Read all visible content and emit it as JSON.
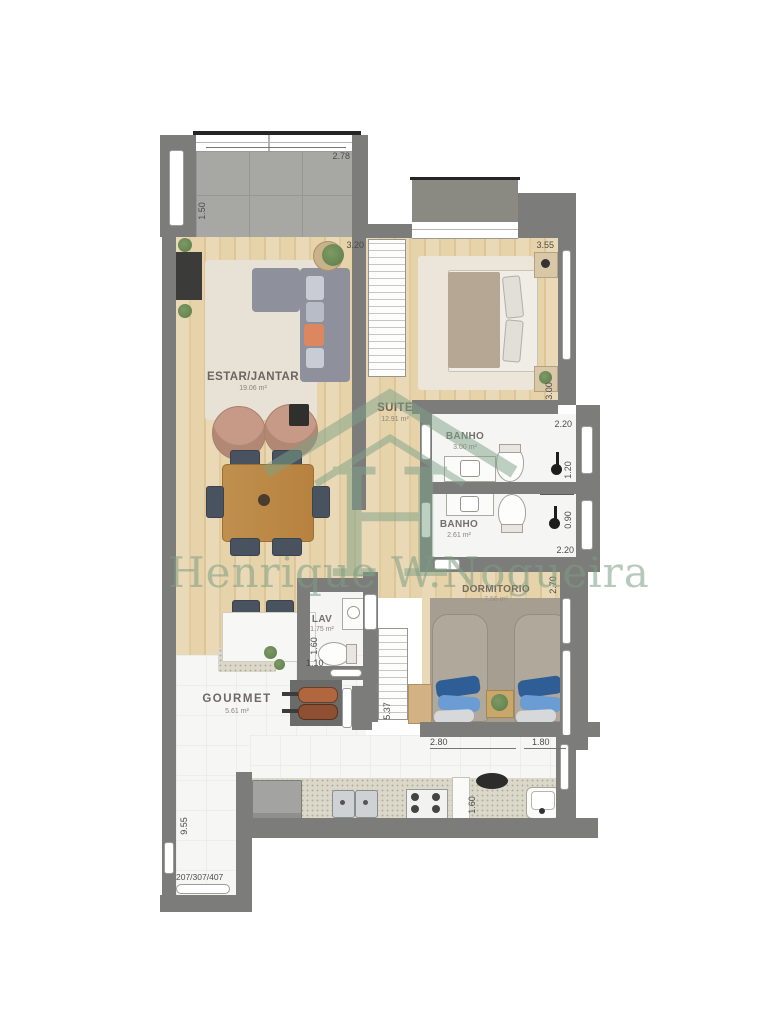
{
  "unit": {
    "numbers": "207/307/407"
  },
  "watermark": {
    "name": "Henrique W.Nogueira",
    "logo_letter": "H",
    "color": "#82a28a"
  },
  "rooms": {
    "estar": {
      "label": "ESTAR/JANTAR",
      "area": "19.06 m²"
    },
    "suite": {
      "label": "SUITE",
      "area": "12.91 m²"
    },
    "banho1": {
      "label": "BANHO",
      "area": "3.00 m²"
    },
    "banho2": {
      "label": "BANHO",
      "area": "2.61 m²"
    },
    "dormitorio": {
      "label": "DORMITORIO",
      "area": "7.56 m²"
    },
    "lav": {
      "label": "LAV",
      "area": "1.75 m²"
    },
    "gourmet": {
      "label": "GOURMET",
      "area": "5.61 m²"
    }
  },
  "dimensions": {
    "terrace_width": "2.78",
    "terrace_depth": "1.50",
    "estar_width": "3.20",
    "suite_width": "3.55",
    "suite_depth": "3.00",
    "banho1_width": "2.20",
    "banho1_depth": "1.20",
    "banho2_depth": "0.90",
    "banho2_width": "2.20",
    "dormitorio_depth": "2.70",
    "closet_run": "5.37",
    "lav_depth": "1.60",
    "lav_width": "1.10",
    "dormitorio_width_a": "2.80",
    "dormitorio_width_b": "1.80",
    "kitchen_depth": "1.60",
    "side_total": "9.55"
  },
  "colors": {
    "wall": "#7c7c7a",
    "wood_floor": "#e6d3aa",
    "terrace_tile": "#a7a7a3",
    "counter": "#dbd8ca",
    "sofa": "#8e909b",
    "accent_cushion": "#dc8760",
    "bed_pillow_blue": "#2e5e95",
    "watermark_green": "#82a28a"
  }
}
